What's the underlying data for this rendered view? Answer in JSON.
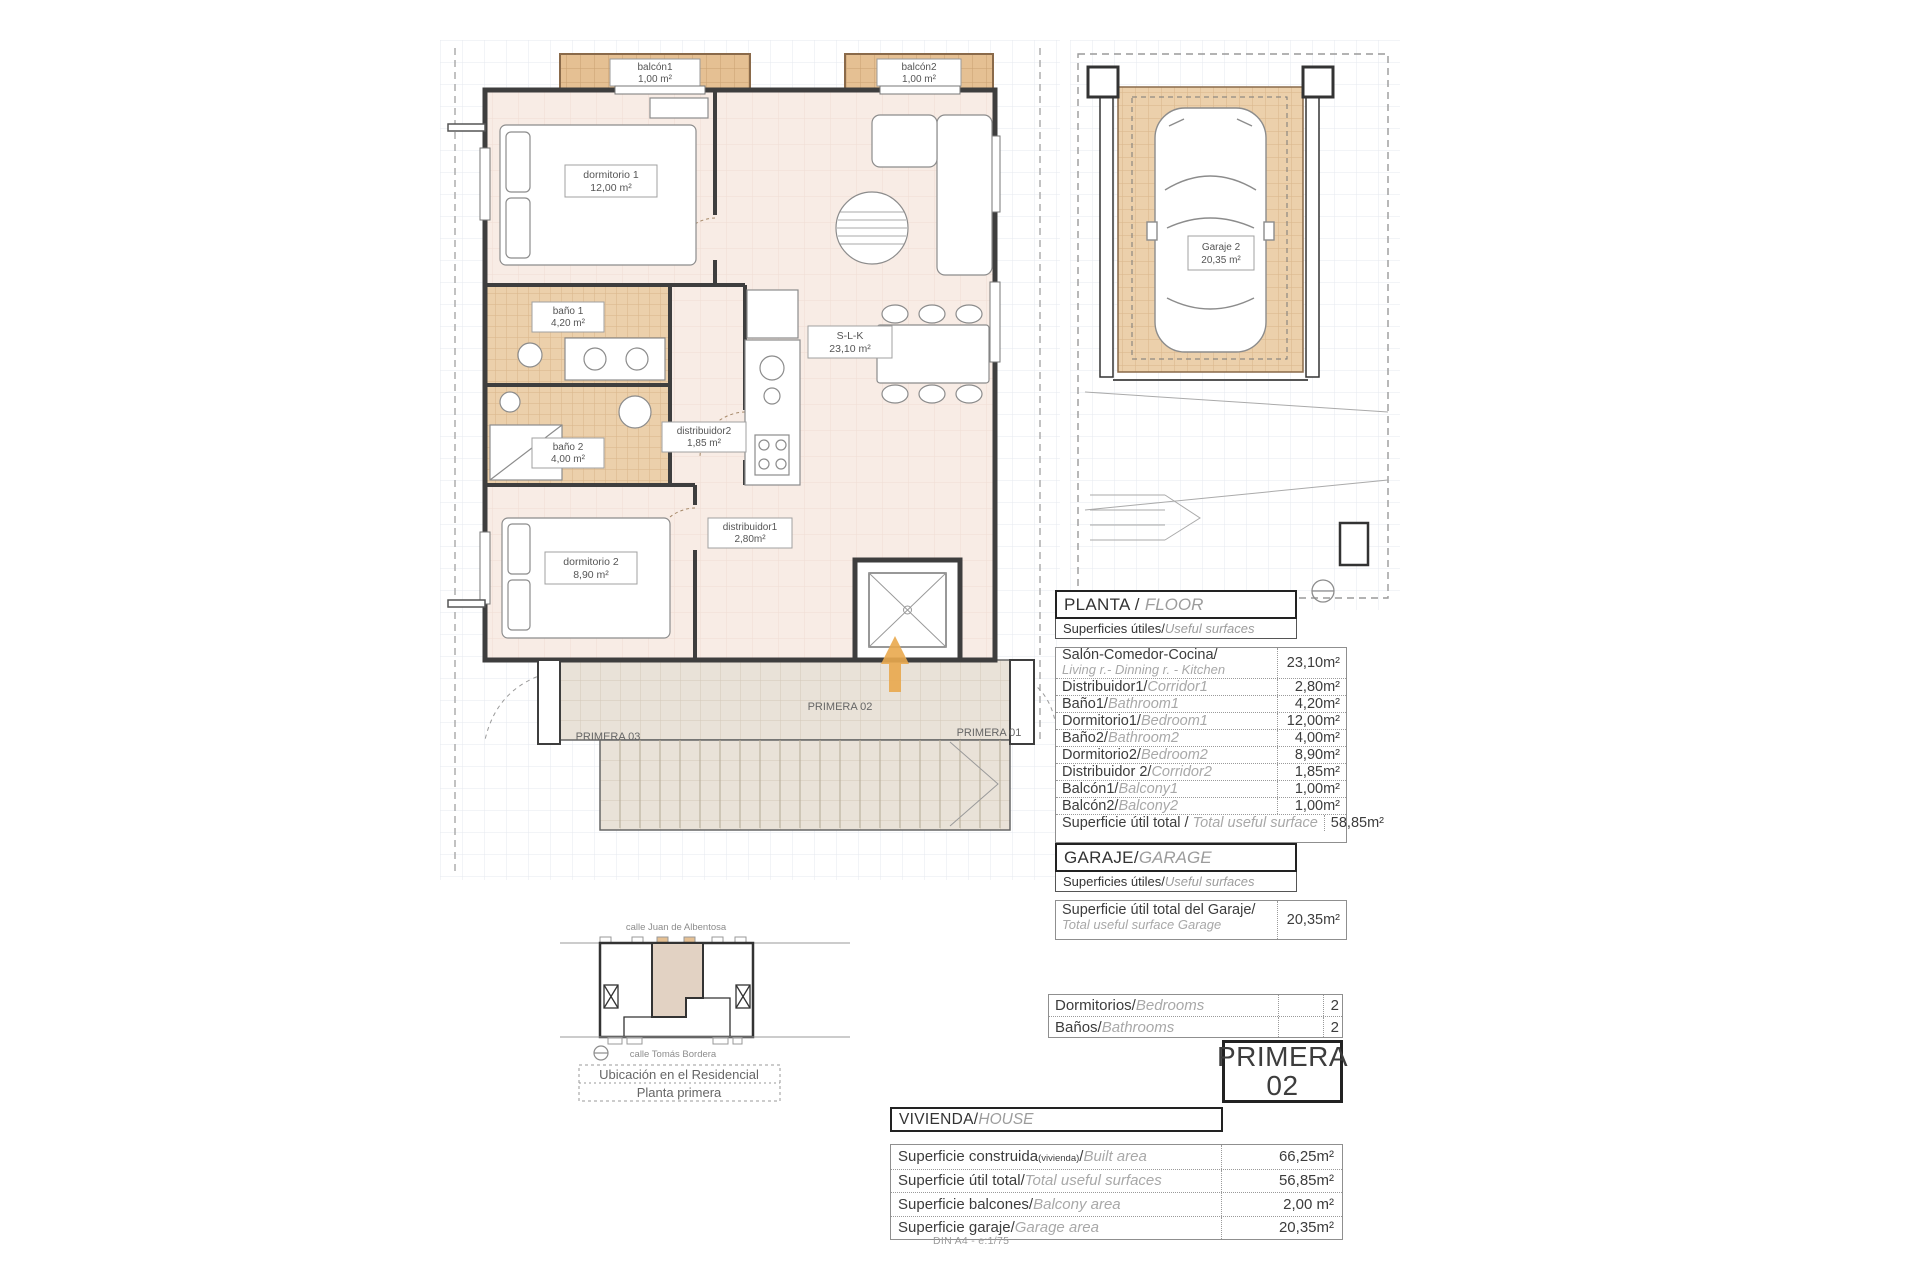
{
  "page": {
    "din_note": "DIN A4 - e:1/75"
  },
  "colors": {
    "tile_tan": "#ecd0ab",
    "balcony_tan": "#e5c093",
    "floor_pink": "#f8ece5",
    "stone_grey": "#e9e2d8",
    "arrow_orange": "#e9a94e",
    "wall_dark": "#3e3e3e"
  },
  "plan": {
    "rooms": {
      "balcon1": {
        "name": "balcón1",
        "area": "1,00 m²"
      },
      "balcon2": {
        "name": "balcón2",
        "area": "1,00 m²"
      },
      "dormitorio1": {
        "name": "dormitorio 1",
        "area": "12,00 m²"
      },
      "bano1": {
        "name": "baño 1",
        "area": "4,20 m²"
      },
      "bano2": {
        "name": "baño 2",
        "area": "4,00 m²"
      },
      "dormitorio2": {
        "name": "dormitorio 2",
        "area": "8,90 m²"
      },
      "distribuidor1": {
        "name": "distribuidor1",
        "area": "2,80m²"
      },
      "distribuidor2": {
        "name": "distribuidor2",
        "area": "1,85 m²"
      },
      "slk": {
        "name": "S-L-K",
        "area": "23,10 m²"
      }
    },
    "landing": {
      "left": "PRIMERA 03",
      "center": "PRIMERA 02",
      "right": "PRIMERA 01"
    }
  },
  "garage_plan": {
    "label": {
      "name": "Garaje 2",
      "area": "20,35 m²"
    }
  },
  "locator": {
    "street_top": "calle Juan de Albentosa",
    "street_bottom": "calle Tomás Bordera",
    "caption_line1": "Ubicación en el Residencial",
    "caption_line2": "Planta primera"
  },
  "planta": {
    "title_es": "PLANTA / ",
    "title_en": "FLOOR",
    "subtitle_es": "Superficies útiles/",
    "subtitle_en": "Useful surfaces",
    "rows": [
      {
        "es": "Salón-Comedor-Cocina/",
        "en": "Living r.- Dinning r. - Kitchen",
        "value": "23,10m²"
      },
      {
        "es": "Distribuidor1/",
        "en": "Corridor1",
        "value": "2,80m²"
      },
      {
        "es": "Baño1/",
        "en": "Bathroom1",
        "value": "4,20m²"
      },
      {
        "es": "Dormitorio1/",
        "en": "Bedroom1",
        "value": "12,00m²"
      },
      {
        "es": "Baño2/",
        "en": "Bathroom2",
        "value": "4,00m²"
      },
      {
        "es": "Dormitorio2/",
        "en": "Bedroom2",
        "value": "8,90m²"
      },
      {
        "es": "Distribuidor 2/",
        "en": "Corridor2",
        "value": "1,85m²"
      },
      {
        "es": "Balcón1/",
        "en": "Balcony1",
        "value": "1,00m²"
      },
      {
        "es": "Balcón2/",
        "en": "Balcony2",
        "value": "1,00m²"
      }
    ],
    "total": {
      "es": "Superficie útil total / ",
      "en": "Total useful surface",
      "value": "58,85m²"
    }
  },
  "garaje": {
    "title_es": "GARAJE/",
    "title_en": "GARAGE",
    "subtitle_es": "Superficies útiles/",
    "subtitle_en": "Useful surfaces",
    "row": {
      "es": "Superficie útil total del Garaje/",
      "en": "Total useful surface Garage",
      "value": "20,35m²"
    }
  },
  "counts": {
    "rows": [
      {
        "es": "Dormitorios/",
        "en": "Bedrooms",
        "value": "2"
      },
      {
        "es": "Baños/",
        "en": "Bathrooms",
        "value": "2"
      }
    ]
  },
  "unit_badge": {
    "line1": "PRIMERA",
    "line2": "02"
  },
  "vivienda": {
    "title_es": "VIVIENDA/",
    "title_en": "HOUSE",
    "rows": [
      {
        "es": "Superficie construida",
        "note": "(vivienda)",
        "slash": "/",
        "en": "Built area",
        "value": "66,25m²"
      },
      {
        "es": "Superficie útil total/",
        "en": "Total useful surfaces",
        "value": "56,85m²"
      },
      {
        "es": "Superficie balcones/",
        "en": "Balcony area",
        "value": "2,00 m²"
      },
      {
        "es": "Superficie garaje/",
        "en": "Garage area",
        "value": "20,35m²"
      }
    ]
  }
}
